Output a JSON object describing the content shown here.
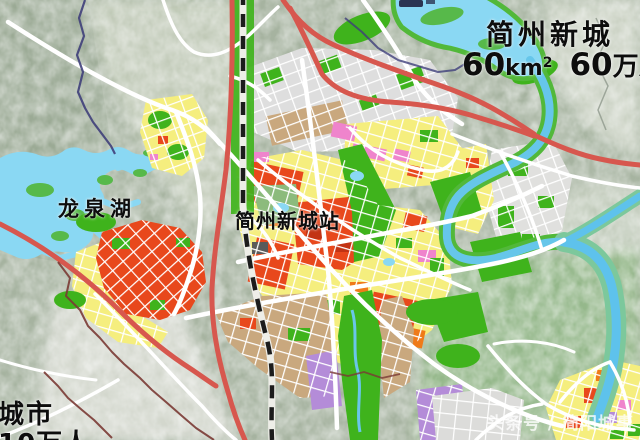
{
  "map": {
    "region_title": "简州新城",
    "stats": {
      "area_value": "60",
      "area_unit": "km",
      "area_exponent": "2",
      "population_value": "60",
      "population_unit": "万人"
    },
    "labels": {
      "lake": "龙泉湖",
      "station": "简州新城站",
      "corner_city": "城市",
      "corner_population": "10万人"
    },
    "watermark": "头条号 / 简阳城事",
    "colors": {
      "hills": "#a6b3a0",
      "valley": "#c3ccba",
      "flat_area": "#d6d9d0",
      "lake_water": "#8ad8f3",
      "river_water": "#66c6ea",
      "park_green": "#3fb31c",
      "soft_green": "#8cbb7c",
      "river_bank": "#7cc89c",
      "block_yellow": "#f5ee7e",
      "block_red": "#e8481c",
      "block_orange": "#ef7a18",
      "block_gray": "#dedede",
      "block_tan": "#c9a87e",
      "block_pink": "#ef84cc",
      "block_purple": "#b48cd8",
      "road": "#ffffff",
      "highway": "#d7574e",
      "railway": "#1c1c1c",
      "boundary_south": "#7a3a34",
      "boundary_north": "#3f3f7a",
      "label_text": "#0d0d0d"
    }
  }
}
